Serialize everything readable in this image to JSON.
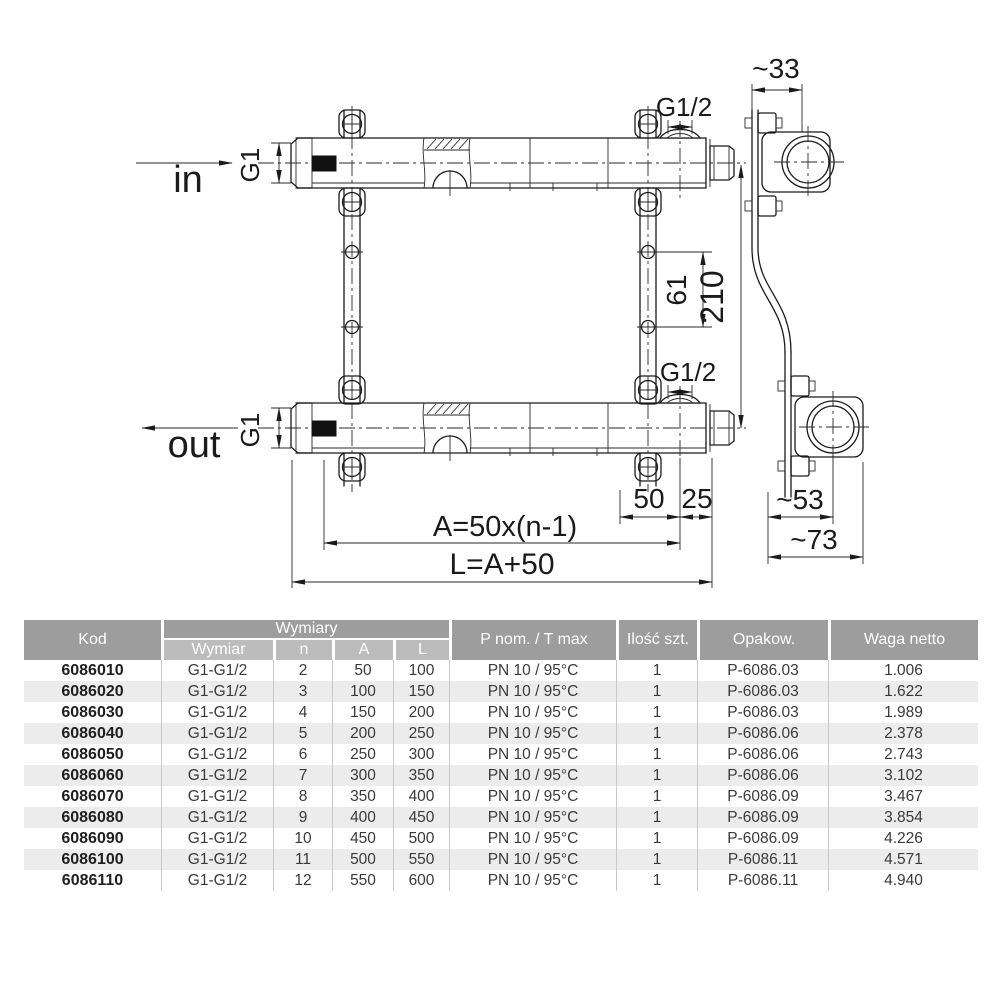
{
  "drawing": {
    "flow_in": "in",
    "flow_out": "out",
    "g1_inlet": "G1",
    "g1_outlet": "G1",
    "g12_top": "G1/2",
    "g12_bottom": "G1/2",
    "dim_33": "~33",
    "dim_61": "61",
    "dim_210": "210",
    "dim_50": "50",
    "dim_25": "25",
    "dim_a_formula": "A=50x(n-1)",
    "dim_l_formula": "L=A+50",
    "dim_53": "~53",
    "dim_73": "~73"
  },
  "table": {
    "headers": {
      "kod": "Kod",
      "wymiary_group": "Wymiary",
      "wymiar": "Wymiar",
      "n": "n",
      "a": "A",
      "l": "L",
      "pnom": "P nom. / T max",
      "ilosc": "Ilość szt.",
      "opakow": "Opakow.",
      "waga": "Waga netto"
    },
    "rows": [
      {
        "kod": "6086010",
        "wymiar": "G1-G1/2",
        "n": "2",
        "a": "50",
        "l": "100",
        "pnom": "PN 10 / 95°C",
        "ilosc": "1",
        "opakow": "P-6086.03",
        "waga": "1.006"
      },
      {
        "kod": "6086020",
        "wymiar": "G1-G1/2",
        "n": "3",
        "a": "100",
        "l": "150",
        "pnom": "PN 10 / 95°C",
        "ilosc": "1",
        "opakow": "P-6086.03",
        "waga": "1.622"
      },
      {
        "kod": "6086030",
        "wymiar": "G1-G1/2",
        "n": "4",
        "a": "150",
        "l": "200",
        "pnom": "PN 10 / 95°C",
        "ilosc": "1",
        "opakow": "P-6086.03",
        "waga": "1.989"
      },
      {
        "kod": "6086040",
        "wymiar": "G1-G1/2",
        "n": "5",
        "a": "200",
        "l": "250",
        "pnom": "PN 10 / 95°C",
        "ilosc": "1",
        "opakow": "P-6086.06",
        "waga": "2.378"
      },
      {
        "kod": "6086050",
        "wymiar": "G1-G1/2",
        "n": "6",
        "a": "250",
        "l": "300",
        "pnom": "PN 10 / 95°C",
        "ilosc": "1",
        "opakow": "P-6086.06",
        "waga": "2.743"
      },
      {
        "kod": "6086060",
        "wymiar": "G1-G1/2",
        "n": "7",
        "a": "300",
        "l": "350",
        "pnom": "PN 10 / 95°C",
        "ilosc": "1",
        "opakow": "P-6086.06",
        "waga": "3.102"
      },
      {
        "kod": "6086070",
        "wymiar": "G1-G1/2",
        "n": "8",
        "a": "350",
        "l": "400",
        "pnom": "PN 10 / 95°C",
        "ilosc": "1",
        "opakow": "P-6086.09",
        "waga": "3.467"
      },
      {
        "kod": "6086080",
        "wymiar": "G1-G1/2",
        "n": "9",
        "a": "400",
        "l": "450",
        "pnom": "PN 10 / 95°C",
        "ilosc": "1",
        "opakow": "P-6086.09",
        "waga": "3.854"
      },
      {
        "kod": "6086090",
        "wymiar": "G1-G1/2",
        "n": "10",
        "a": "450",
        "l": "500",
        "pnom": "PN 10 / 95°C",
        "ilosc": "1",
        "opakow": "P-6086.09",
        "waga": "4.226"
      },
      {
        "kod": "6086100",
        "wymiar": "G1-G1/2",
        "n": "11",
        "a": "500",
        "l": "550",
        "pnom": "PN 10 / 95°C",
        "ilosc": "1",
        "opakow": "P-6086.11",
        "waga": "4.571"
      },
      {
        "kod": "6086110",
        "wymiar": "G1-G1/2",
        "n": "12",
        "a": "550",
        "l": "600",
        "pnom": "PN 10 / 95°C",
        "ilosc": "1",
        "opakow": "P-6086.11",
        "waga": "4.940"
      }
    ]
  },
  "colors": {
    "header_bg": "#9d9d9d",
    "subheader_bg": "#bcbcbc",
    "row_alt_bg": "#ececec",
    "column_line": "#c8c8c8",
    "drawing_line": "#1a1a1a"
  }
}
